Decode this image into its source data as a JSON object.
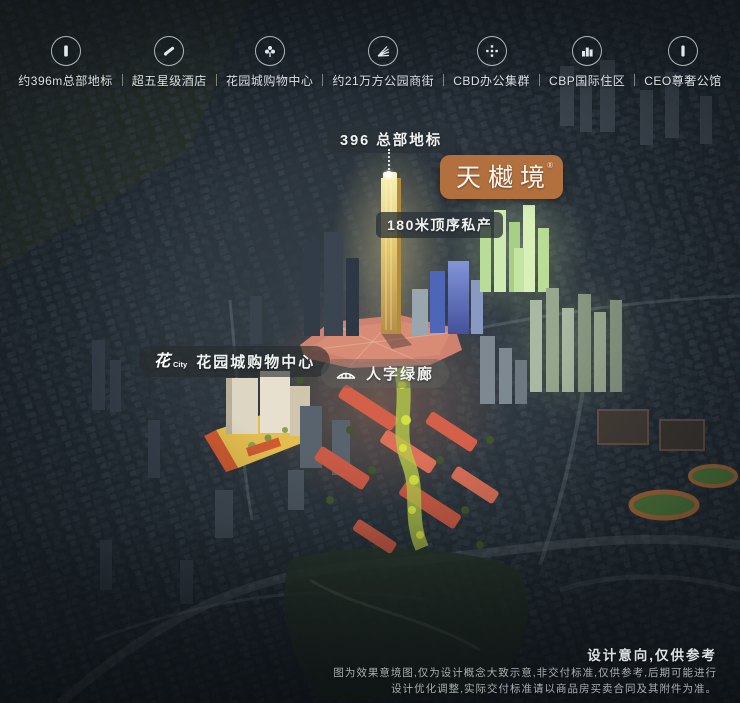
{
  "legend": {
    "items": [
      {
        "icon": "tower-icon",
        "label": "约396m总部地标"
      },
      {
        "icon": "hotel-icon",
        "label": "超五星级酒店"
      },
      {
        "icon": "mall-flower-icon",
        "label": "花园城购物中心"
      },
      {
        "icon": "park-street-icon",
        "label": "约21万方公园商街"
      },
      {
        "icon": "cbd-office-icon",
        "label": "CBD办公集群"
      },
      {
        "icon": "residence-icon",
        "label": "CBP国际住区"
      },
      {
        "icon": "mansion-icon",
        "label": "CEO尊奢公馆"
      }
    ]
  },
  "callouts": {
    "landmark": {
      "label": "396 总部地标"
    },
    "brand": {
      "label": "天樾境",
      "registered_mark": "®",
      "color": "#b2703f"
    },
    "premium": {
      "label": "180米顶序私产"
    },
    "mall": {
      "logo_cn": "花",
      "logo_en": "City",
      "label": "花园城购物中心"
    },
    "greenway": {
      "label": "人字绿廊"
    }
  },
  "disclaimer": {
    "title": "设计意向,仅供参考",
    "line1": "图为效果意境图,仅为设计概念大致示意,非交付标准,仅供参考,后期可能进行",
    "line2": "设计优化调整,实际交付标准请以商品房买卖合同及其附件为准。"
  },
  "scene_colors": {
    "base": "#232c34",
    "gold_tower": "#e3c76e",
    "blue_tower": "#5a6fc0",
    "green_cluster": "#c8e6a8",
    "commercial_red": "#d4604a",
    "mall_podium": "#e3bd4e"
  }
}
